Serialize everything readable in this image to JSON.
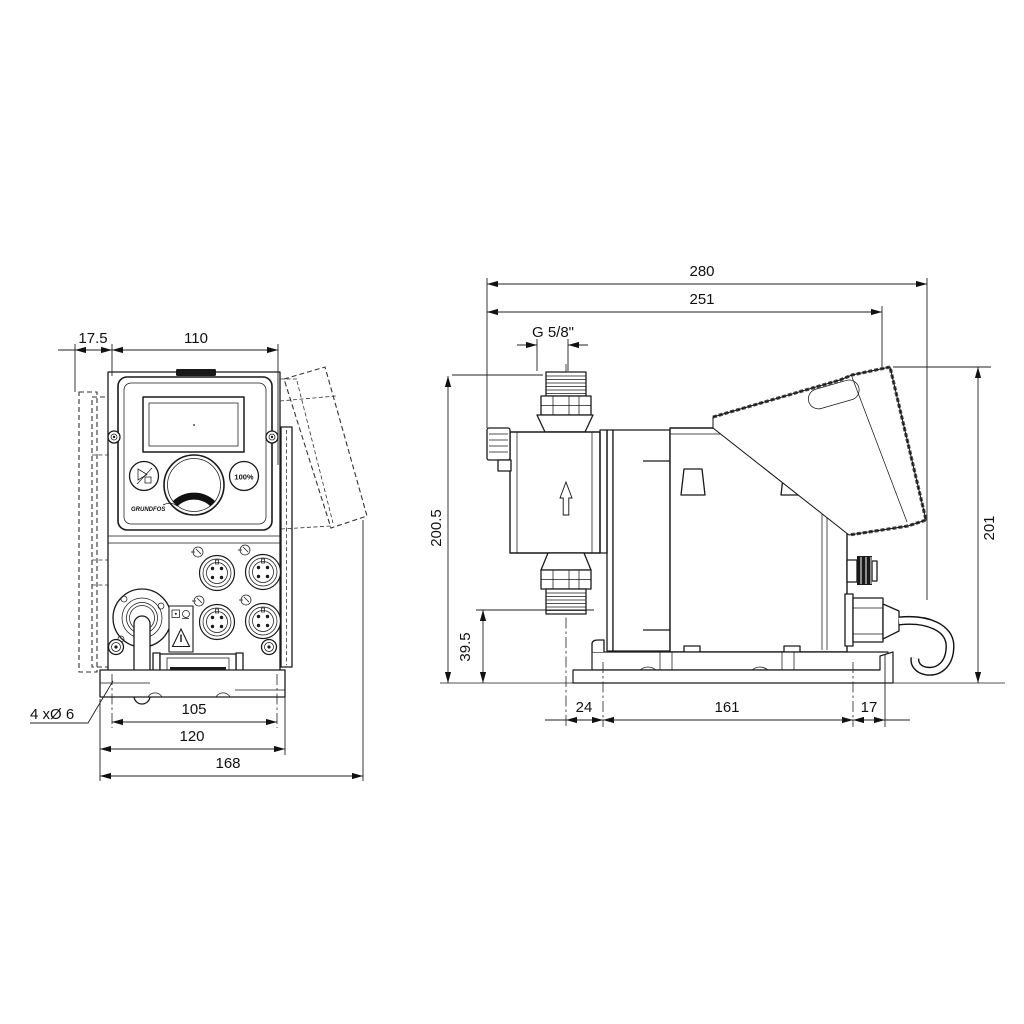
{
  "drawing": {
    "kind": "dimensional-drawing",
    "front_view": {
      "dims": {
        "offset": "17.5",
        "width": "110",
        "hole_pitch": "105",
        "bracket_width": "120",
        "depth_overall": "168",
        "mounting_holes": "4 xØ 6"
      },
      "panel": {
        "percent_button": "100%",
        "logo": "GRUNDFOS"
      }
    },
    "side_view": {
      "dims": {
        "overall_length": "280",
        "cover_length": "251",
        "thread": "G 5/8\"",
        "height_discharge": "200.5",
        "height_suction": "39.5",
        "overall_height": "201",
        "front_offset": "24",
        "base_length": "161",
        "rear_offset": "17"
      }
    }
  }
}
